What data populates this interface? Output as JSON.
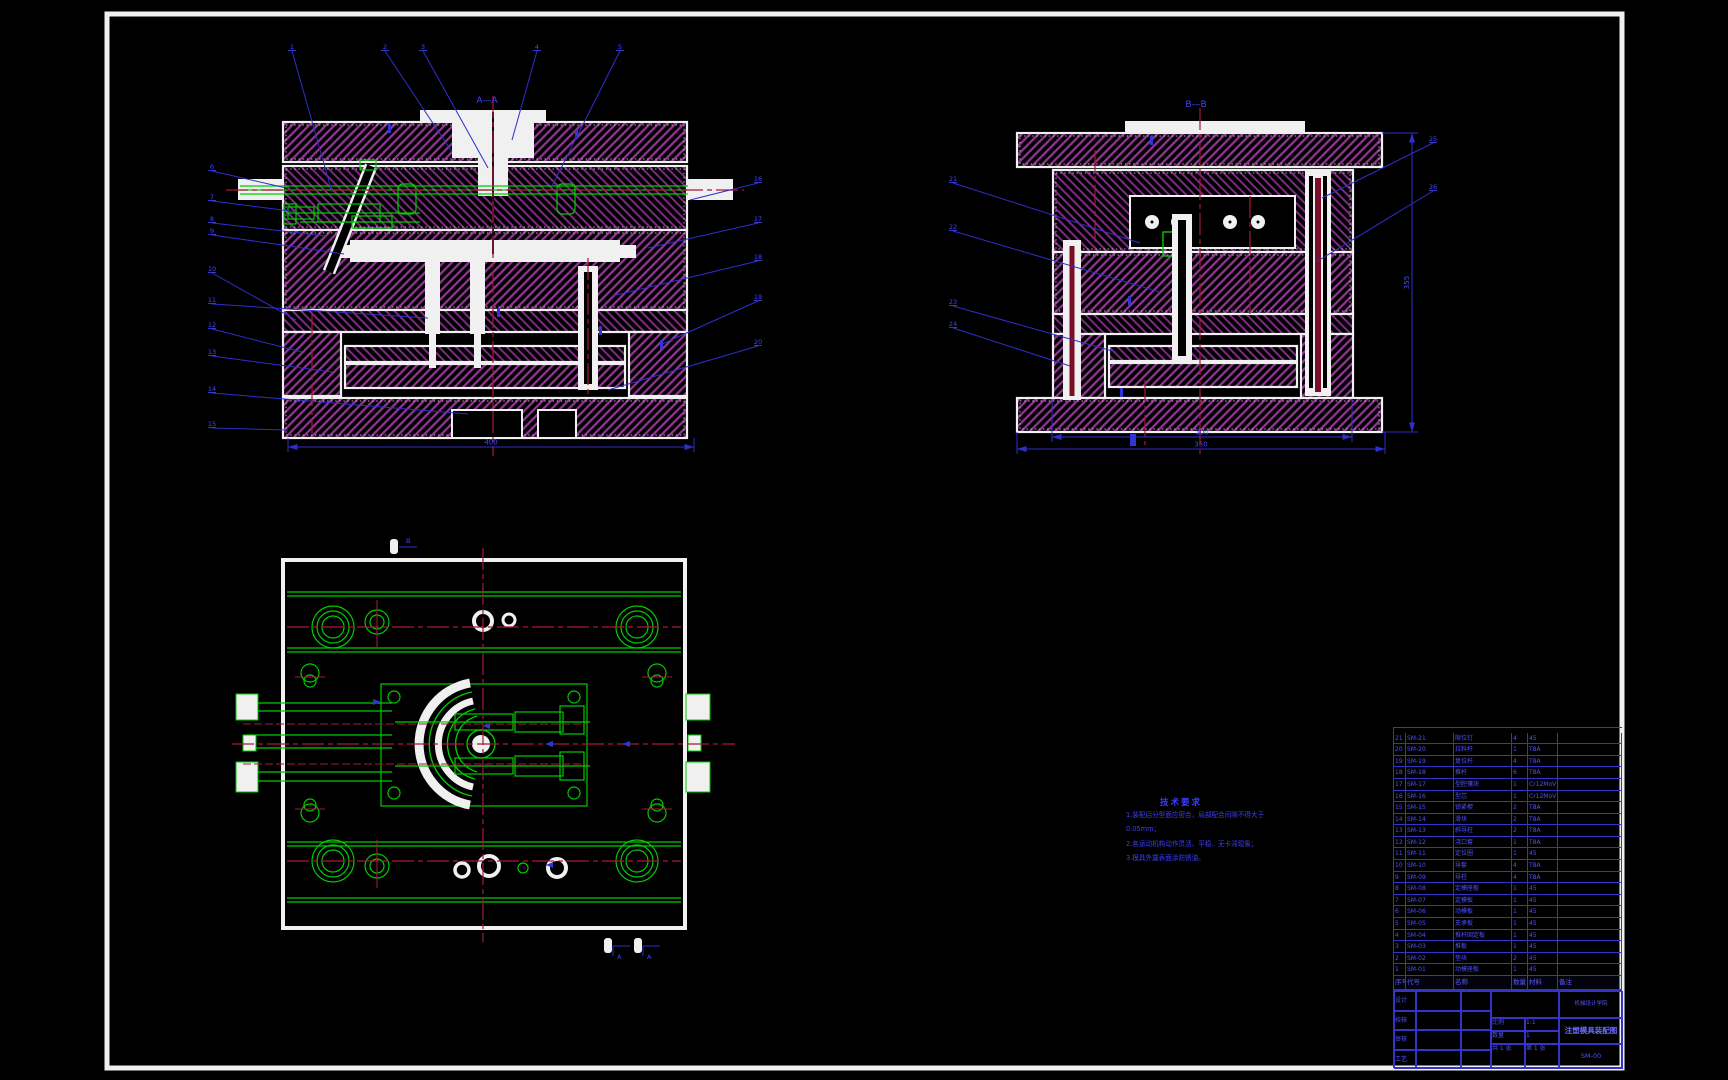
{
  "drawing": {
    "section_labels": {
      "front": "A—A",
      "side": "B—B"
    },
    "notes": {
      "title": "技术要求",
      "lines": [
        "1.装配后分型面应密合，局部配合间隙不得大于",
        "0.05mm；",
        "2.各运动机构动作灵活、平稳、无卡滞现象；",
        "3.模具外露表面涂防锈油。"
      ]
    },
    "colors": {
      "background": "#000000",
      "frame": "#f0f0f0",
      "hatch_magenta": "#8f3590",
      "green": "#00cc00",
      "centerline_red": "#a81638",
      "annotation_blue": "#2e2ecc",
      "text_blue": "#4444ff"
    },
    "markers": {
      "top": "B",
      "bottom_left": "A",
      "bottom_right": "A"
    },
    "dims": [
      {
        "x1": 288,
        "y1": 447,
        "x2": 694,
        "y2": 447,
        "v": "400"
      },
      {
        "x1": 1052,
        "y1": 437,
        "x2": 1352,
        "y2": 437,
        "v": "300"
      },
      {
        "x1": 1017,
        "y1": 449,
        "x2": 1385,
        "y2": 449,
        "v": "350"
      },
      {
        "x1": 1412,
        "y1": 133,
        "x2": 1412,
        "y2": 432,
        "v": "355",
        "vert": true
      }
    ],
    "leaders": [
      {
        "x": 292,
        "y": 48,
        "tx": 332,
        "ty": 192,
        "n": "1"
      },
      {
        "x": 385,
        "y": 48,
        "tx": 452,
        "ty": 152,
        "n": "2"
      },
      {
        "x": 423,
        "y": 48,
        "tx": 488,
        "ty": 168,
        "n": "3"
      },
      {
        "x": 537,
        "y": 48,
        "tx": 512,
        "ty": 140,
        "n": "4"
      },
      {
        "x": 620,
        "y": 48,
        "tx": 552,
        "ty": 186,
        "n": "5"
      },
      {
        "x": 212,
        "y": 168,
        "tx": 286,
        "ty": 188,
        "n": "6"
      },
      {
        "x": 212,
        "y": 198,
        "tx": 298,
        "ty": 212,
        "n": "7"
      },
      {
        "x": 212,
        "y": 220,
        "tx": 326,
        "ty": 236,
        "n": "8"
      },
      {
        "x": 212,
        "y": 232,
        "tx": 344,
        "ty": 254,
        "n": "9"
      },
      {
        "x": 212,
        "y": 270,
        "tx": 296,
        "ty": 320,
        "n": "10"
      },
      {
        "x": 212,
        "y": 301,
        "tx": 428,
        "ty": 318,
        "n": "11"
      },
      {
        "x": 212,
        "y": 326,
        "tx": 302,
        "ty": 352,
        "n": "12"
      },
      {
        "x": 212,
        "y": 353,
        "tx": 332,
        "ty": 372,
        "n": "13"
      },
      {
        "x": 212,
        "y": 390,
        "tx": 468,
        "ty": 414,
        "n": "14"
      },
      {
        "x": 212,
        "y": 425,
        "tx": 288,
        "ty": 430,
        "n": "15"
      },
      {
        "x": 758,
        "y": 180,
        "tx": 690,
        "ty": 200,
        "n": "16"
      },
      {
        "x": 758,
        "y": 220,
        "tx": 648,
        "ty": 248,
        "n": "17"
      },
      {
        "x": 758,
        "y": 258,
        "tx": 612,
        "ty": 296,
        "n": "18"
      },
      {
        "x": 758,
        "y": 298,
        "tx": 662,
        "ty": 344,
        "n": "19"
      },
      {
        "x": 758,
        "y": 343,
        "tx": 608,
        "ty": 390,
        "n": "20"
      },
      {
        "x": 953,
        "y": 180,
        "tx": 1140,
        "ty": 243,
        "n": "21"
      },
      {
        "x": 953,
        "y": 228,
        "tx": 1160,
        "ty": 292,
        "n": "22"
      },
      {
        "x": 953,
        "y": 303,
        "tx": 1116,
        "ty": 352,
        "n": "23"
      },
      {
        "x": 953,
        "y": 325,
        "tx": 1070,
        "ty": 366,
        "n": "24"
      },
      {
        "x": 1433,
        "y": 140,
        "tx": 1322,
        "ty": 198,
        "n": "25"
      },
      {
        "x": 1433,
        "y": 188,
        "tx": 1316,
        "ty": 262,
        "n": "26"
      }
    ]
  },
  "bom": {
    "headers": [
      "序号",
      "代号",
      "名称",
      "数量",
      "材料",
      "备注"
    ],
    "rows": [
      {
        "no": "21",
        "code": "SM-21",
        "name": "限位钉",
        "qty": "4",
        "mat": "45",
        "note": ""
      },
      {
        "no": "20",
        "code": "SM-20",
        "name": "拉料杆",
        "qty": "1",
        "mat": "T8A",
        "note": ""
      },
      {
        "no": "19",
        "code": "SM-19",
        "name": "复位杆",
        "qty": "4",
        "mat": "T8A",
        "note": ""
      },
      {
        "no": "18",
        "code": "SM-18",
        "name": "推杆",
        "qty": "6",
        "mat": "T8A",
        "note": ""
      },
      {
        "no": "17",
        "code": "SM-17",
        "name": "型腔镶块",
        "qty": "1",
        "mat": "Cr12MoV",
        "note": ""
      },
      {
        "no": "16",
        "code": "SM-16",
        "name": "型芯",
        "qty": "1",
        "mat": "Cr12MoV",
        "note": ""
      },
      {
        "no": "15",
        "code": "SM-15",
        "name": "锁紧楔",
        "qty": "2",
        "mat": "T8A",
        "note": ""
      },
      {
        "no": "14",
        "code": "SM-14",
        "name": "滑块",
        "qty": "2",
        "mat": "T8A",
        "note": ""
      },
      {
        "no": "13",
        "code": "SM-13",
        "name": "斜导柱",
        "qty": "2",
        "mat": "T8A",
        "note": ""
      },
      {
        "no": "12",
        "code": "SM-12",
        "name": "浇口套",
        "qty": "1",
        "mat": "T8A",
        "note": ""
      },
      {
        "no": "11",
        "code": "SM-11",
        "name": "定位圈",
        "qty": "1",
        "mat": "45",
        "note": ""
      },
      {
        "no": "10",
        "code": "SM-10",
        "name": "导套",
        "qty": "4",
        "mat": "T8A",
        "note": ""
      },
      {
        "no": "9",
        "code": "SM-09",
        "name": "导柱",
        "qty": "4",
        "mat": "T8A",
        "note": ""
      },
      {
        "no": "8",
        "code": "SM-08",
        "name": "定模座板",
        "qty": "1",
        "mat": "45",
        "note": ""
      },
      {
        "no": "7",
        "code": "SM-07",
        "name": "定模板",
        "qty": "1",
        "mat": "45",
        "note": ""
      },
      {
        "no": "6",
        "code": "SM-06",
        "name": "动模板",
        "qty": "1",
        "mat": "45",
        "note": ""
      },
      {
        "no": "5",
        "code": "SM-05",
        "name": "支承板",
        "qty": "1",
        "mat": "45",
        "note": ""
      },
      {
        "no": "4",
        "code": "SM-04",
        "name": "推杆固定板",
        "qty": "1",
        "mat": "45",
        "note": ""
      },
      {
        "no": "3",
        "code": "SM-03",
        "name": "推板",
        "qty": "1",
        "mat": "45",
        "note": ""
      },
      {
        "no": "2",
        "code": "SM-02",
        "name": "垫块",
        "qty": "2",
        "mat": "45",
        "note": ""
      },
      {
        "no": "1",
        "code": "SM-01",
        "name": "动模座板",
        "qty": "1",
        "mat": "45",
        "note": ""
      }
    ]
  },
  "titleblock": {
    "left_rows": [
      {
        "label": "设计",
        "name": "",
        "date": ""
      },
      {
        "label": "校核",
        "name": "",
        "date": ""
      },
      {
        "label": "审核",
        "name": "",
        "date": ""
      },
      {
        "label": "工艺",
        "name": "",
        "date": ""
      }
    ],
    "scale_label": "比例",
    "scale_value": "1:1",
    "qty_label": "数量",
    "qty_value": "1",
    "sheet_left": "共 1 张",
    "sheet_right": "第 1 张",
    "unit_name": "机械设计学院",
    "drawing_title": "注塑模具装配图",
    "drawing_no": "SM-00"
  }
}
